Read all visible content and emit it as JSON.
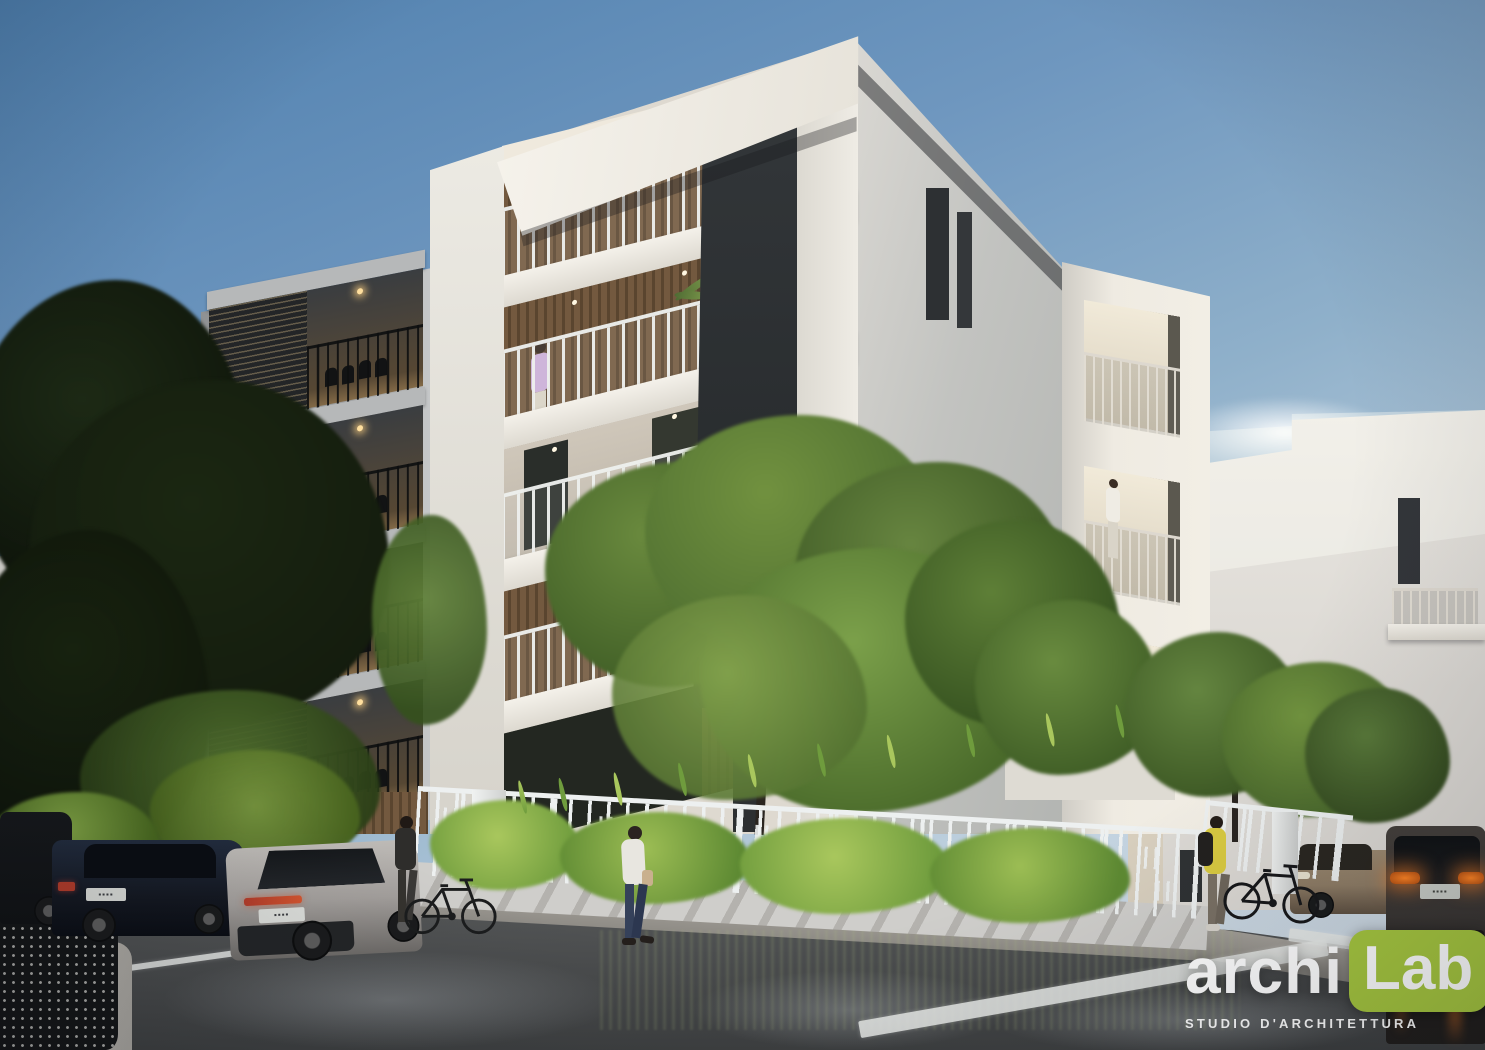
{
  "brand": {
    "name": "archiLab",
    "part1": "archi",
    "part2": "Lab",
    "tagline": "STUDIO D'ARCHITETTURA"
  },
  "colors": {
    "sky_top": "#4e7fae",
    "sky_mid": "#8fb0ca",
    "sky_horizon": "#c3d3e0",
    "white_hi": "#f4f1ea",
    "white": "#e9e6df",
    "white_shade": "#c9c9c5",
    "wood_a": "#73593f",
    "wood_b": "#5a452f",
    "dark_slab": "#2e3234",
    "charcoal": "#232628",
    "concrete": "#a5a7a9",
    "concrete_hi": "#c6c8c9",
    "railing": "#eef0ee",
    "tower_a": "#efebe2",
    "tower_b": "#cfccc5",
    "bg_bldg": "#dcd9d4",
    "bg_bldg_lit": "#eae7e1",
    "cream": "#d8cfbe",
    "tree_dark": "#141c0e",
    "tree_dark2": "#0e140a",
    "tree_green": "#4c6c30",
    "tree_green2": "#5f8038",
    "tree_light": "#85a44e",
    "fence": "#edf0f0",
    "fence_base": "#cfcecb",
    "plant_green": "#6f9c3d",
    "plant_light": "#a9c75d",
    "road_a": "#5a5c5d",
    "road_b": "#3e4041",
    "sidewalk": "#a09c95",
    "marking": "#e8eae8",
    "car_navy": "#141821",
    "car_silver": "#a39f9c",
    "car_dark": "#3b3734",
    "car_black": "#101214",
    "car_bronze": "#8f7d66",
    "tail_orange": "#ff8424",
    "tail_red": "#b23c2a",
    "logo_green": "#a7c83f",
    "white_text": "#ffffff",
    "lamp": "#b9bcbe",
    "shirt_lavender": "#c9aed6",
    "shirt_white": "#e8e6e0",
    "jeans": "#35415a",
    "jacket_yellow": "#d9ca41",
    "backpack": "#23211f",
    "bin": "#141517",
    "pink": "#c2556a"
  }
}
